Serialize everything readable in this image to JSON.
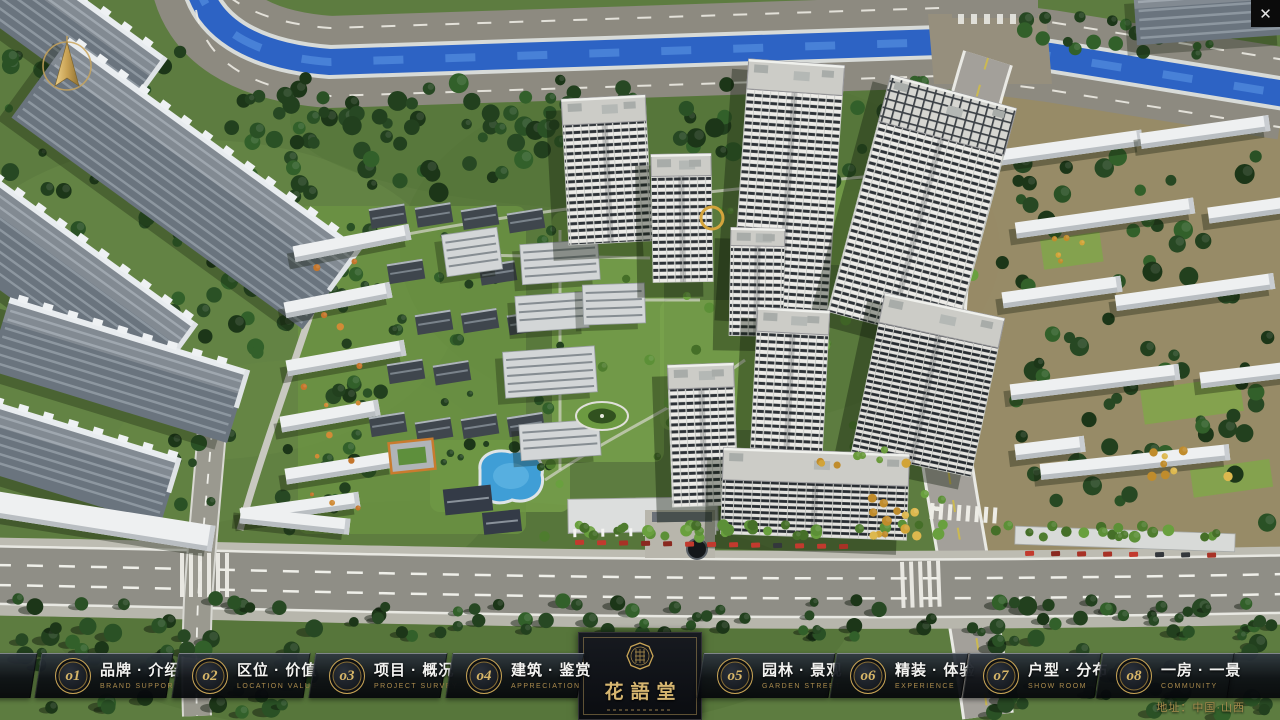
{
  "window": {
    "close_icon": "✕"
  },
  "nav": {
    "items": [
      {
        "number": "o1",
        "label_zh": "品牌 · 介绍",
        "label_en": "BRAND SUPPORT"
      },
      {
        "number": "o2",
        "label_zh": "区位 · 价值",
        "label_en": "LOCATION VALUE"
      },
      {
        "number": "o3",
        "label_zh": "项目 · 概况",
        "label_en": "PROJECT SURVEY"
      },
      {
        "number": "o4",
        "label_zh": "建筑 · 鉴赏",
        "label_en": "APPRECIATION"
      },
      {
        "number": "o5",
        "label_zh": "园林 · 景观",
        "label_en": "GARDEN STREET"
      },
      {
        "number": "o6",
        "label_zh": "精装 · 体验",
        "label_en": "EXPERIENCE"
      },
      {
        "number": "o7",
        "label_zh": "户型 · 分布",
        "label_en": "SHOW ROOM"
      },
      {
        "number": "o8",
        "label_zh": "一房 · 一景",
        "label_en": "COMMUNITY"
      }
    ]
  },
  "logo": {
    "title": "花語堂"
  },
  "footer": {
    "address": "地址：中国·山西"
  },
  "colors": {
    "accent_gold": "#c9a556",
    "panel_dark": "#0c0f14",
    "river_blue": "#2d63c4"
  }
}
